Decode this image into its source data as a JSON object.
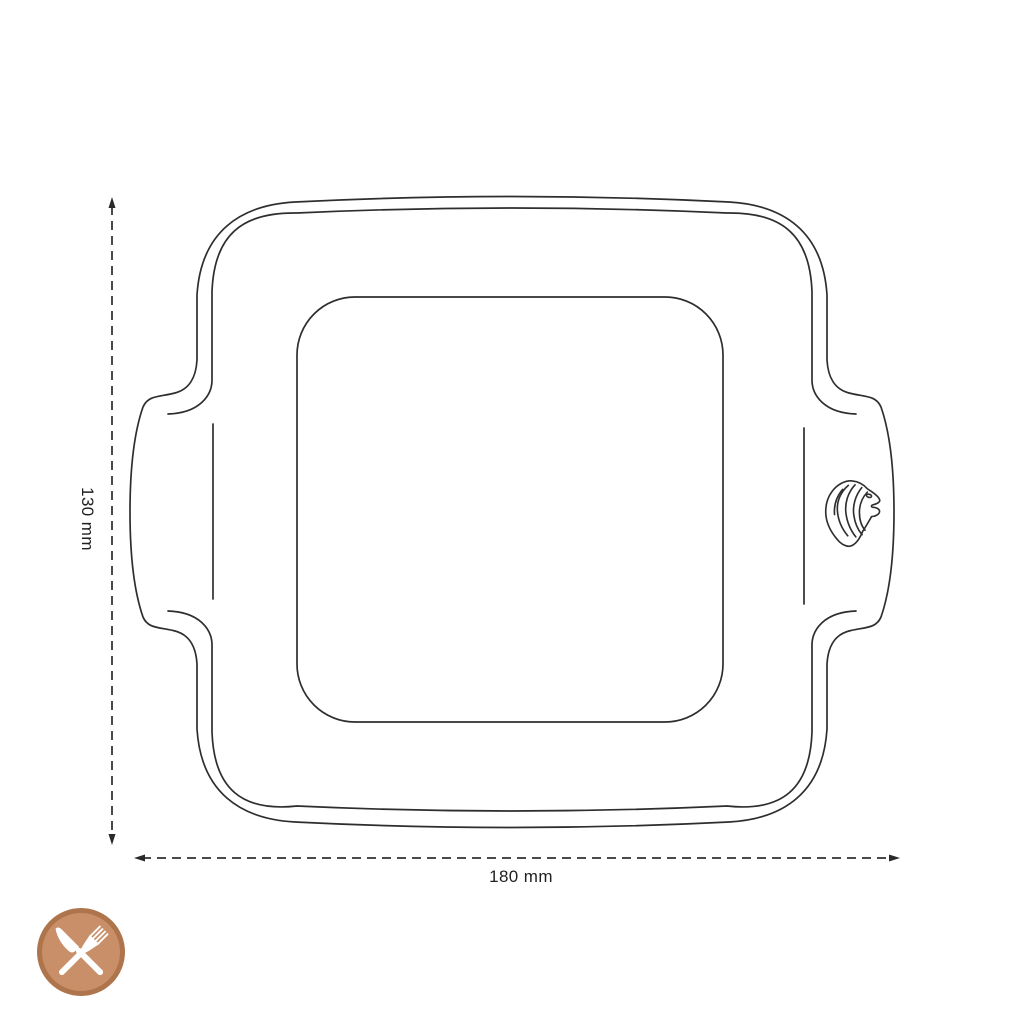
{
  "labels": {
    "height": "130 mm",
    "width": "180 mm"
  },
  "colors": {
    "background": "#ffffff",
    "line": "#2e2e2e",
    "dimension_line": "#4a4a4a",
    "arrow": "#2a2a2a",
    "text": "#1f1f1f",
    "badge_fill": "#c98f68",
    "badge_ring": "#ae744c",
    "badge_glyph": "#ffffff"
  },
  "icons": {
    "logo": "lion-head",
    "badge": "fork-and-knife"
  }
}
